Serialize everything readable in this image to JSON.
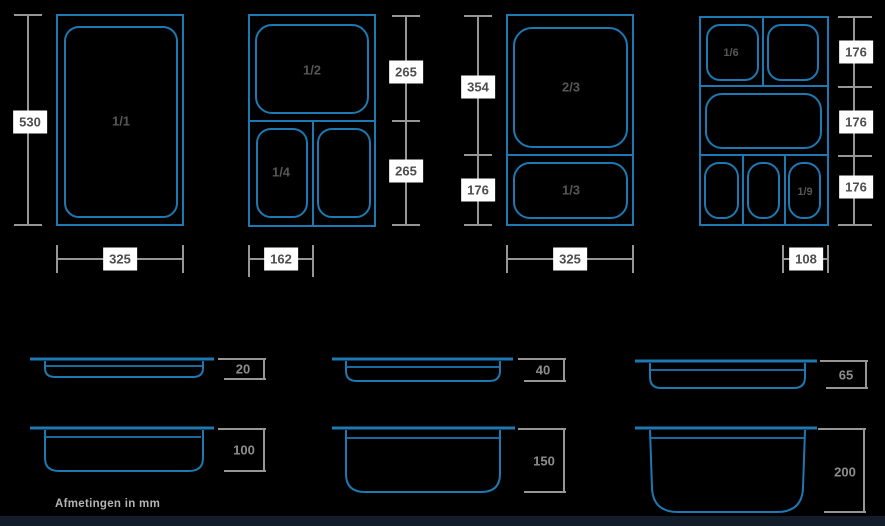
{
  "colors": {
    "background": "#000000",
    "pan_outline_blue": "#1e78b1",
    "dimension_line_gray": "#969696",
    "dimension_label_bg": "#ffffff",
    "dimension_label_text": "#4d4d4d",
    "compartment_label_text": "#565656",
    "depth_label_text": "#8d8d8d",
    "footer_text": "#b4b4b4",
    "footer_bar": "#121d29"
  },
  "panels": [
    {
      "compartments": {
        "c1": "1/1"
      },
      "dims": {
        "height": "530",
        "width": "325"
      }
    },
    {
      "compartments": {
        "c1": "1/2",
        "c2": "1/4"
      },
      "dims": {
        "seg1": "265",
        "seg2": "265",
        "width": "162"
      }
    },
    {
      "compartments": {
        "c1": "2/3",
        "c2": "1/3"
      },
      "dims": {
        "seg1": "354",
        "seg2": "176",
        "width": "325"
      }
    },
    {
      "compartments": {
        "c1": "1/6",
        "c2": "1/9"
      },
      "dims": {
        "seg1": "176",
        "seg2": "176",
        "seg3": "176",
        "width": "108"
      }
    }
  ],
  "profiles": [
    {
      "depth": "20"
    },
    {
      "depth": "40"
    },
    {
      "depth": "65"
    },
    {
      "depth": "100"
    },
    {
      "depth": "150"
    },
    {
      "depth": "200"
    }
  ],
  "footer": {
    "note": "Afmetingen in mm"
  }
}
